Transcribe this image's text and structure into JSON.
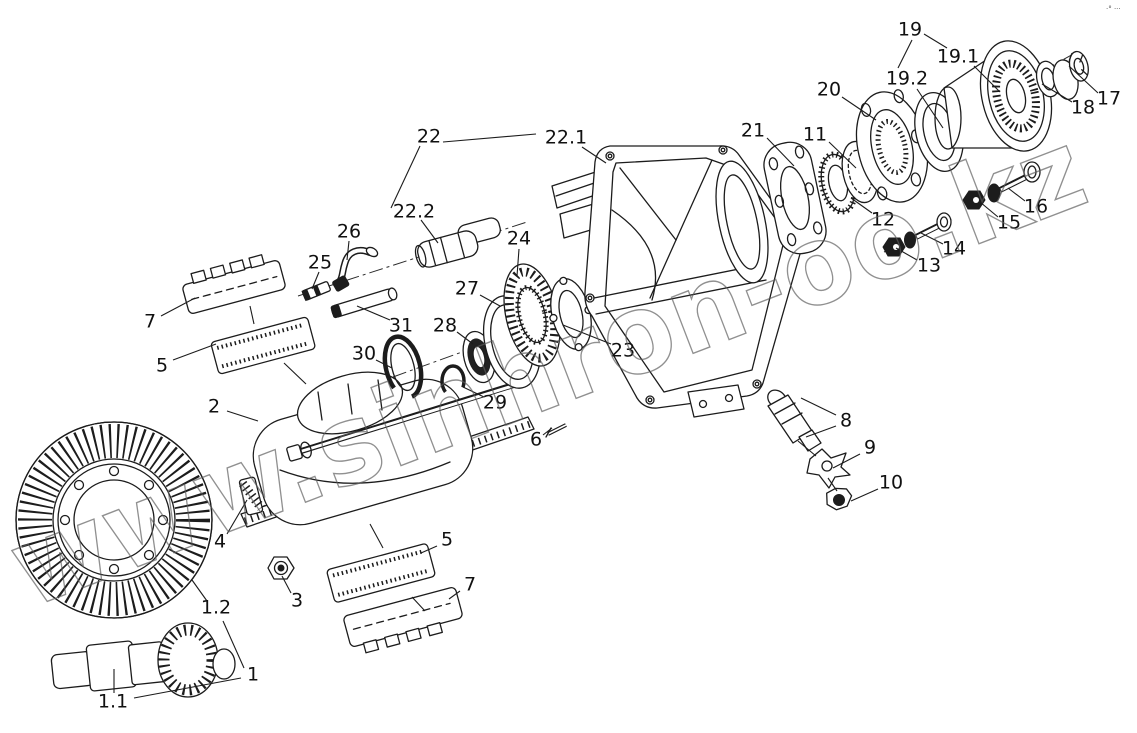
{
  "diagram": {
    "type": "exploded-parts-line-drawing",
    "watermark": "www.sinhron-oo.kz",
    "corner_mark": "·° ···",
    "callouts": [
      {
        "label": "19"
      },
      {
        "label": "19.1"
      },
      {
        "label": "19.2"
      },
      {
        "label": "20"
      },
      {
        "label": "21"
      },
      {
        "label": "11"
      },
      {
        "label": "12"
      },
      {
        "label": "13"
      },
      {
        "label": "14"
      },
      {
        "label": "15"
      },
      {
        "label": "16"
      },
      {
        "label": "17"
      },
      {
        "label": "18"
      },
      {
        "label": "22"
      },
      {
        "label": "22.1"
      },
      {
        "label": "22.2"
      },
      {
        "label": "24"
      },
      {
        "label": "25"
      },
      {
        "label": "26"
      },
      {
        "label": "27"
      },
      {
        "label": "28"
      },
      {
        "label": "29"
      },
      {
        "label": "30"
      },
      {
        "label": "31"
      },
      {
        "label": "23"
      },
      {
        "label": "2"
      },
      {
        "label": "4"
      },
      {
        "label": "6"
      },
      {
        "label": "8"
      },
      {
        "label": "9"
      },
      {
        "label": "10"
      },
      {
        "label": "3"
      },
      {
        "label": "5"
      },
      {
        "label": "7"
      },
      {
        "label": "5"
      },
      {
        "label": "7"
      },
      {
        "label": "1"
      },
      {
        "label": "1.1"
      },
      {
        "label": "1.2"
      }
    ]
  }
}
